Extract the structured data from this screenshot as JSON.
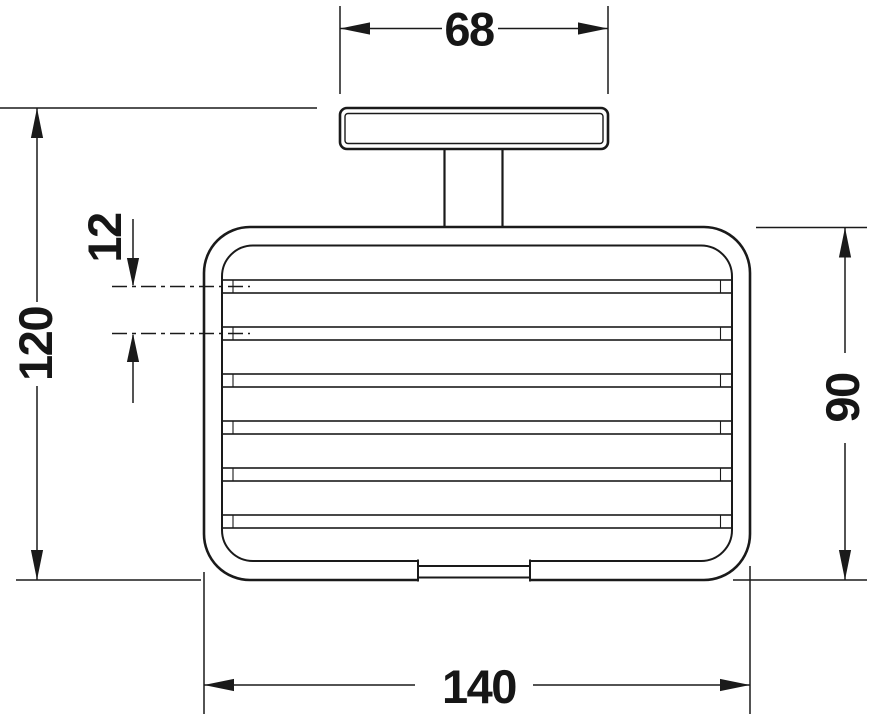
{
  "drawing": {
    "subject": "wall-mounted-soap-basket-front-elevation",
    "background_color": "#ffffff",
    "line_color": "#1a1a1a",
    "bar_count": 6,
    "dimensions": {
      "plate_width": {
        "value": "68",
        "placement": "top",
        "orientation": "horizontal"
      },
      "overall_height": {
        "value": "120",
        "placement": "left",
        "orientation": "vertical"
      },
      "bar_spacing": {
        "value": "12",
        "placement": "left-center",
        "orientation": "vertical"
      },
      "basket_height": {
        "value": "90",
        "placement": "right",
        "orientation": "vertical"
      },
      "basket_width": {
        "value": "140",
        "placement": "bottom",
        "orientation": "horizontal"
      }
    }
  }
}
